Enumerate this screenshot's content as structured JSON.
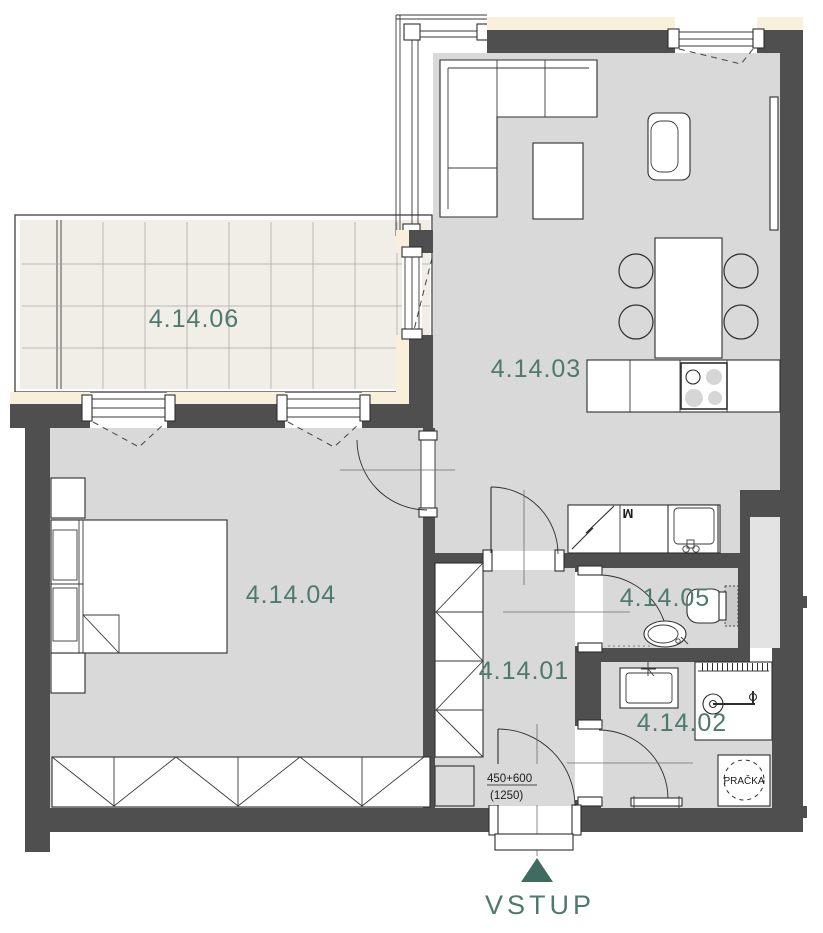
{
  "floor_plan": {
    "rooms": [
      {
        "label": "4.14.06"
      },
      {
        "label": "4.14.03"
      },
      {
        "label": "4.14.04"
      },
      {
        "label": "4.14.01"
      },
      {
        "label": "4.14.05"
      },
      {
        "label": "4.14.02"
      }
    ],
    "entrance": {
      "label": "VSTUP",
      "door_dimension": "450+600",
      "door_dimension_total": "(1250)"
    },
    "appliances": {
      "washing_machine": "PRAČKA",
      "meter_mark": "M"
    },
    "colors": {
      "label_teal": "#4d7a6e",
      "arrow_teal": "#3f6b60",
      "wall_dark": "#4f4f4f",
      "floor_gray": "#d9d9d9",
      "insulation_cream": "#f8f0db",
      "balcony_tile": "#f1eee8"
    }
  }
}
